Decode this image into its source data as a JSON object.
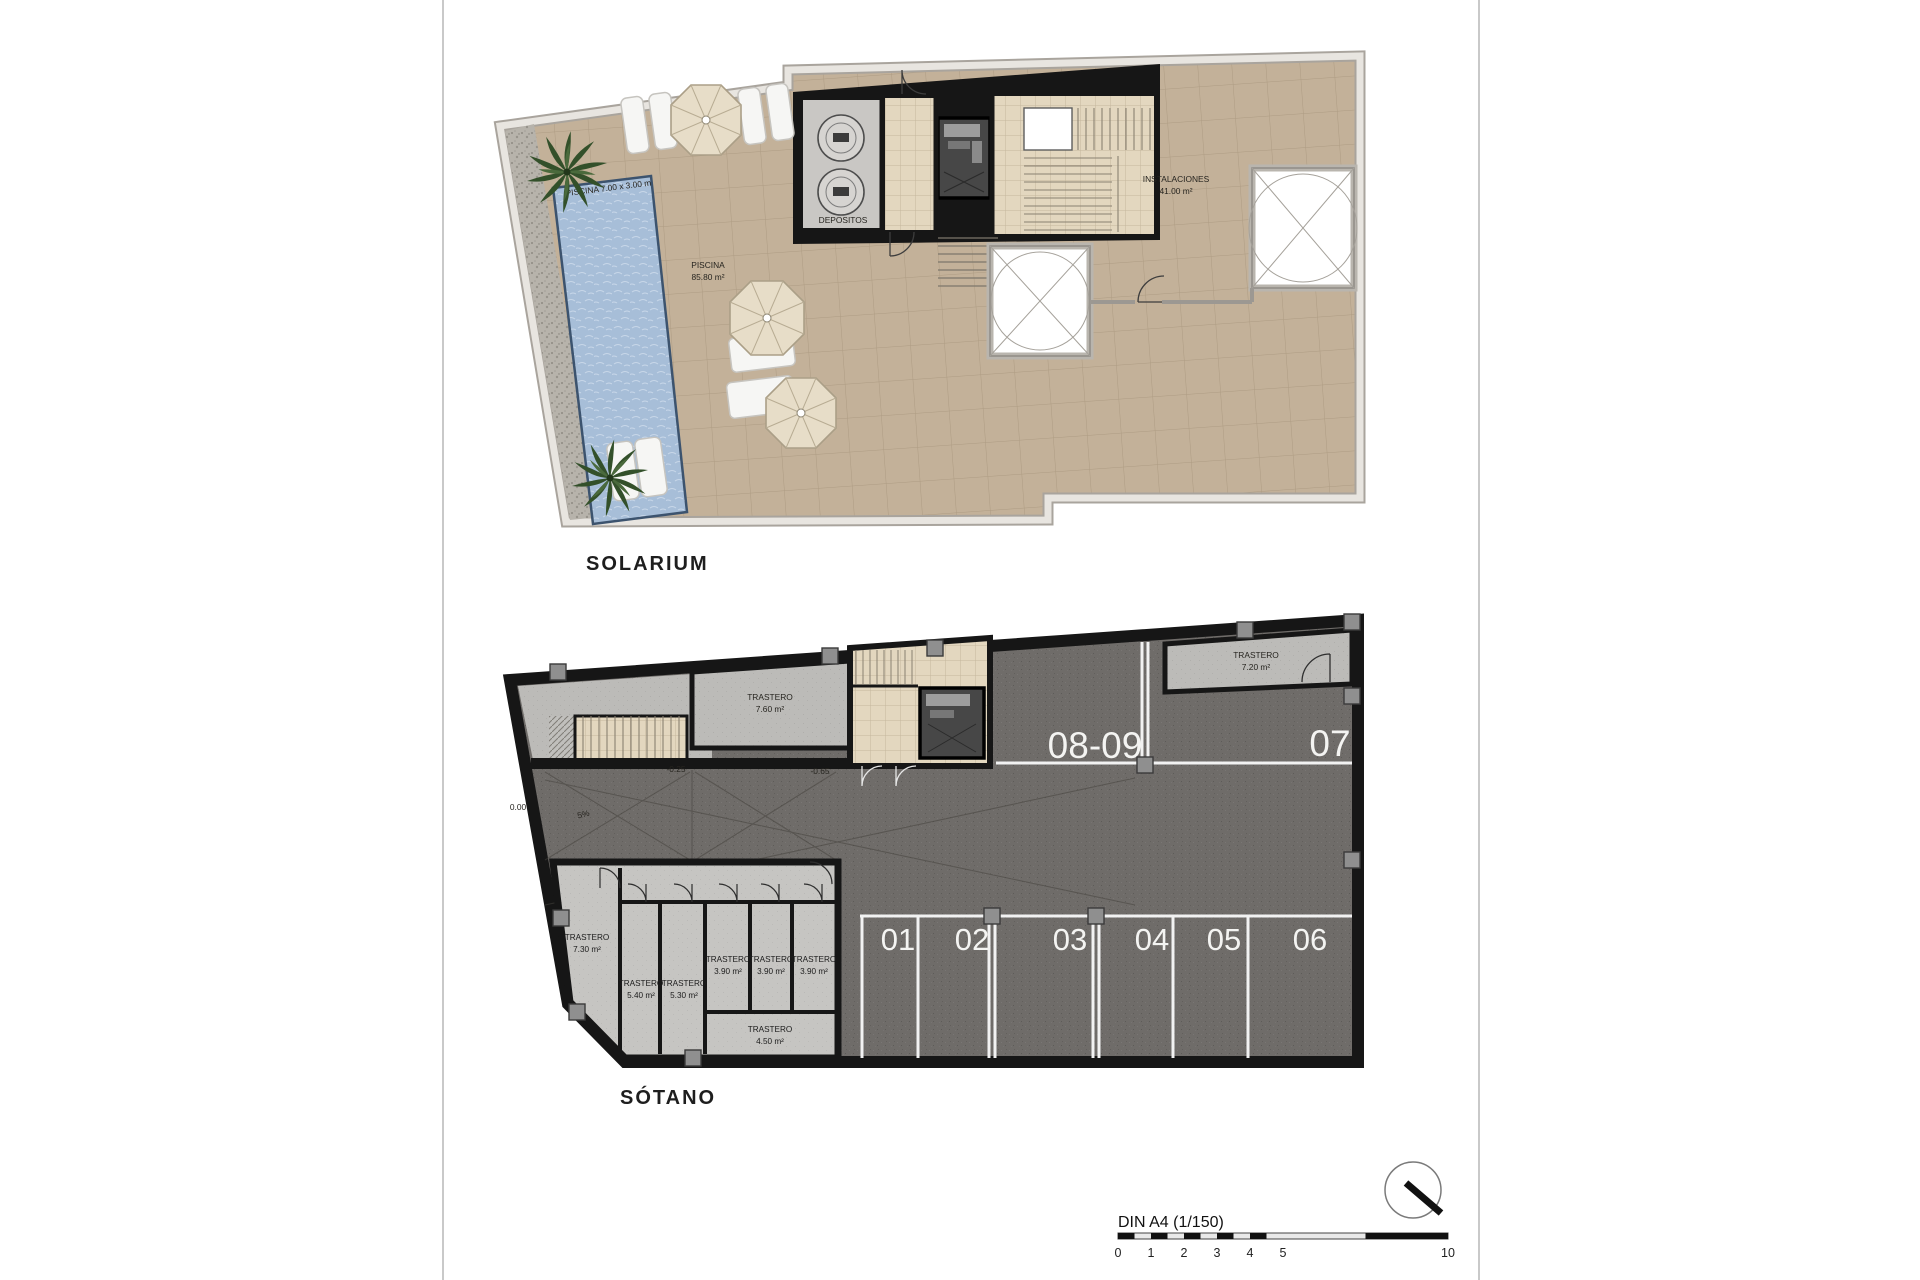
{
  "page": {
    "solarium_title": "SOLARIUM",
    "sotano_title": "SÓTANO"
  },
  "solarium": {
    "pool_dim_label": "PISCINA 7.00 x 3.00 m",
    "pool_area": {
      "name": "PISCINA",
      "area": "85.80 m²"
    },
    "depositos_label": "DEPOSITOS",
    "instalaciones": {
      "name": "INSTALACIONES",
      "area": "41.00 m²"
    }
  },
  "sotano": {
    "parking_spaces": [
      "01",
      "02",
      "03",
      "04",
      "05",
      "06"
    ],
    "parking_large": [
      "08-09",
      "07"
    ],
    "storage_rooms": [
      {
        "name": "TRASTERO",
        "area": "7.60 m²"
      },
      {
        "name": "TRASTERO",
        "area": "7.20 m²"
      },
      {
        "name": "TRASTERO",
        "area": "7.30 m²"
      },
      {
        "name": "TRASTERO",
        "area": "5.40 m²"
      },
      {
        "name": "TRASTERO",
        "area": "5.30 m²"
      },
      {
        "name": "TRASTERO",
        "area": "3.90 m²"
      },
      {
        "name": "TRASTERO",
        "area": "3.90 m²"
      },
      {
        "name": "TRASTERO",
        "area": "3.90 m²"
      },
      {
        "name": "TRASTERO",
        "area": "4.50 m²"
      }
    ],
    "levels": {
      "entry": "0.00",
      "ramp_slope": "5%",
      "mid": "-0.25",
      "lower": "-0.65"
    }
  },
  "scalebar": {
    "title": "DIN A4 (1/150)",
    "ticks": [
      "0",
      "1",
      "2",
      "3",
      "4",
      "5",
      "10"
    ]
  },
  "colors": {
    "terrace_tan": "#c3b199",
    "tile_beige": "#e3d7bf",
    "pool_blue": "#a7bed8",
    "parking_gray": "#6f6c69",
    "wall_black": "#161616",
    "wall_light": "#b3afa7",
    "room_light": "#bcbbb8",
    "white_line": "#f2f2f2"
  }
}
